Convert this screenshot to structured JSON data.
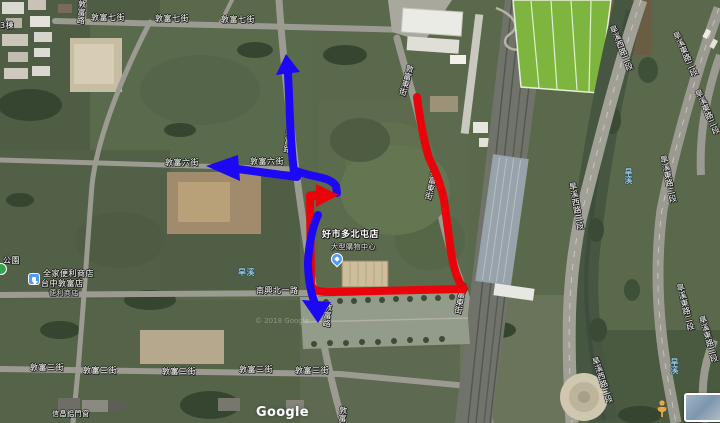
{
  "map": {
    "street_labels": [
      {
        "text": "敦富七街"
      },
      {
        "text": "敦富七街"
      },
      {
        "text": "敦富七街"
      },
      {
        "text": "敦富六街"
      },
      {
        "text": "敦富六街"
      },
      {
        "text": "南興北一路"
      },
      {
        "text": "敦富三街"
      },
      {
        "text": "敦富三街"
      },
      {
        "text": "敦富三街"
      },
      {
        "text": "敦富三街"
      },
      {
        "text": "敦富三街"
      },
      {
        "text": "3棟"
      }
    ],
    "vertical_labels": [
      {
        "text": "敦富路"
      },
      {
        "text": "敦富路"
      },
      {
        "text": "敦富路"
      },
      {
        "text": "敦富路"
      },
      {
        "text": "敦富東街"
      },
      {
        "text": "敦富東街"
      },
      {
        "text": "敦富東街"
      },
      {
        "text": "旱溪西路二段"
      },
      {
        "text": "旱溪西路二段"
      },
      {
        "text": "旱溪西路二段"
      },
      {
        "text": "旱溪東路二段"
      },
      {
        "text": "旱溪東路二段"
      },
      {
        "text": "旱溪東路二段"
      },
      {
        "text": "旱溪東路二段"
      },
      {
        "text": "旱溪東路二段"
      }
    ],
    "water_labels": [
      {
        "text": "旱溪"
      },
      {
        "text": "旱溪"
      },
      {
        "text": "旱溪"
      }
    ],
    "pois": {
      "costco": {
        "name": "好市多北屯店",
        "sub": "大型購物中心"
      },
      "familymart": {
        "line1": "全家便利商店",
        "line2": "台中敦富店",
        "line3": "便利商店"
      },
      "park": {
        "name": "公園"
      },
      "shop": {
        "name": "信昌鋁門窗"
      }
    },
    "logo": "Google",
    "watermark": "© 2018 Google"
  },
  "routes": {
    "red_color": "#e8040a",
    "blue_color": "#1c08f2",
    "red_description": "loop route around Costco site ending with east arrow",
    "blue_description": "route along Dunfu Rd with arrows up, west and down"
  },
  "colors": {
    "field_base": "#5a684c",
    "road": "#9b9b91",
    "sports_field": "#7eb53f",
    "water_text": "#bfe4f5",
    "poi_pin_blue": "#4f9bf7",
    "park_green": "#33a24f",
    "pegman_orange": "#eda83c"
  }
}
